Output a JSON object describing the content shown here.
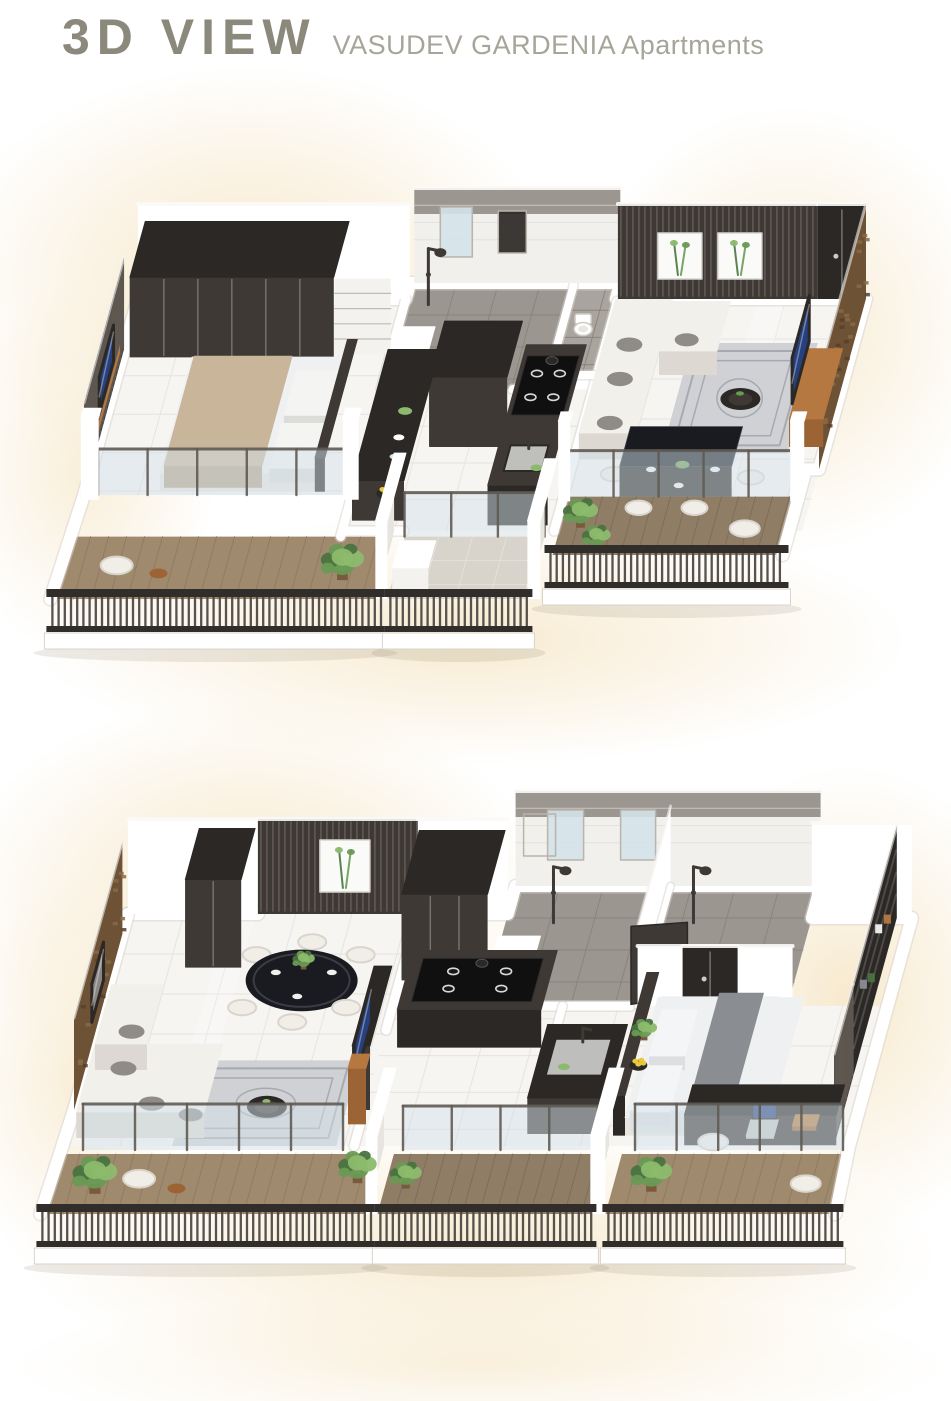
{
  "header": {
    "title": "3D VIEW",
    "subtitle": "VASUDEV GARDENIA Apartments"
  },
  "units": [
    {
      "id": "unit-a-3d-view",
      "label": "upper apartment 3d view",
      "rooms": [
        "bedroom",
        "bathroom",
        "toilet-bath",
        "kitchen",
        "living-room",
        "dining-area",
        "bedroom-balcony",
        "utility-balcony",
        "dining-balcony"
      ],
      "furniture": [
        "wardrobe",
        "double-bed",
        "tv-slat-wall",
        "shower",
        "kitchen-counter",
        "gas-hob",
        "sink",
        "fruit-bowl",
        "sofa",
        "rug",
        "coffee-table",
        "tv-cabinet",
        "stone-tv-wall",
        "dining-table",
        "dining-chairs",
        "balcony-railing",
        "glass-partition",
        "potted-plants",
        "wall-art"
      ]
    },
    {
      "id": "unit-b-3d-view",
      "label": "lower apartment 3d view",
      "rooms": [
        "living-room",
        "dining-area",
        "kitchen",
        "bathroom",
        "toilet",
        "bedroom",
        "living-balcony",
        "kitchen-balcony",
        "bedroom-balcony"
      ],
      "furniture": [
        "stone-accent-wall",
        "slat-wall-art",
        "dining-table",
        "dining-chairs",
        "sofa",
        "rug",
        "coffee-table",
        "tv-panel",
        "gas-hob",
        "sink-counter",
        "shower",
        "toilet",
        "open-door",
        "double-bed",
        "wardrobe-shelves",
        "study-desk",
        "laptop",
        "desk-chair",
        "balcony-railing",
        "glass-partition",
        "potted-plants"
      ]
    }
  ],
  "palette": {
    "glowC": "#f4e2bd",
    "wall": "#ffffff",
    "wallShade": "#e8e5e0",
    "edgeU": "#d8d4ce",
    "floor": "#f6f5f2",
    "floorLine": "#e4e2dd",
    "grayTile": "#9b968f",
    "grayTile2": "#a9a49d",
    "grayLine": "#87827b",
    "whiteTile": "#f2f0ec",
    "dark": "#3e3935",
    "dark2": "#2b2825",
    "slat": "#7d756b",
    "stone": "#6e5236",
    "stone2": "#8a6a45",
    "stoneD": "#57402a",
    "wood": "#a08a6e",
    "woodLine": "#8c7a62",
    "woodD": "#8f7d66",
    "woodLineD": "#7c6c58",
    "balcTile": "#d8d3cb",
    "rail": "#302d2a",
    "railSlat": "#4e4943",
    "glass": "#d4e2e9",
    "glassPost": "#5f5a53",
    "sofa": "#f2f0eb",
    "sofaSh": "#ddd9d2",
    "cushion": "#8f8c88",
    "rug": "#cdcfd3",
    "rugLine": "#a6aab0",
    "bedTan": "#c8b59a",
    "bedTanD": "#b5a289",
    "bedWhite": "#eef0f1",
    "throw": "#8a8d92",
    "tvUnit": "#b57840",
    "tvUnitD": "#9c6434",
    "tableBlack": "#191b20",
    "chair": "#f1eee8",
    "chairSh": "#d9d5cc",
    "screen": "#27407e",
    "plant": "#699a53",
    "plantD": "#4a7340",
    "plantL": "#8cba6d",
    "steel": "#c6c6c4",
    "shelfW": "#f4f2ee",
    "burner": "#d9d9d9"
  }
}
